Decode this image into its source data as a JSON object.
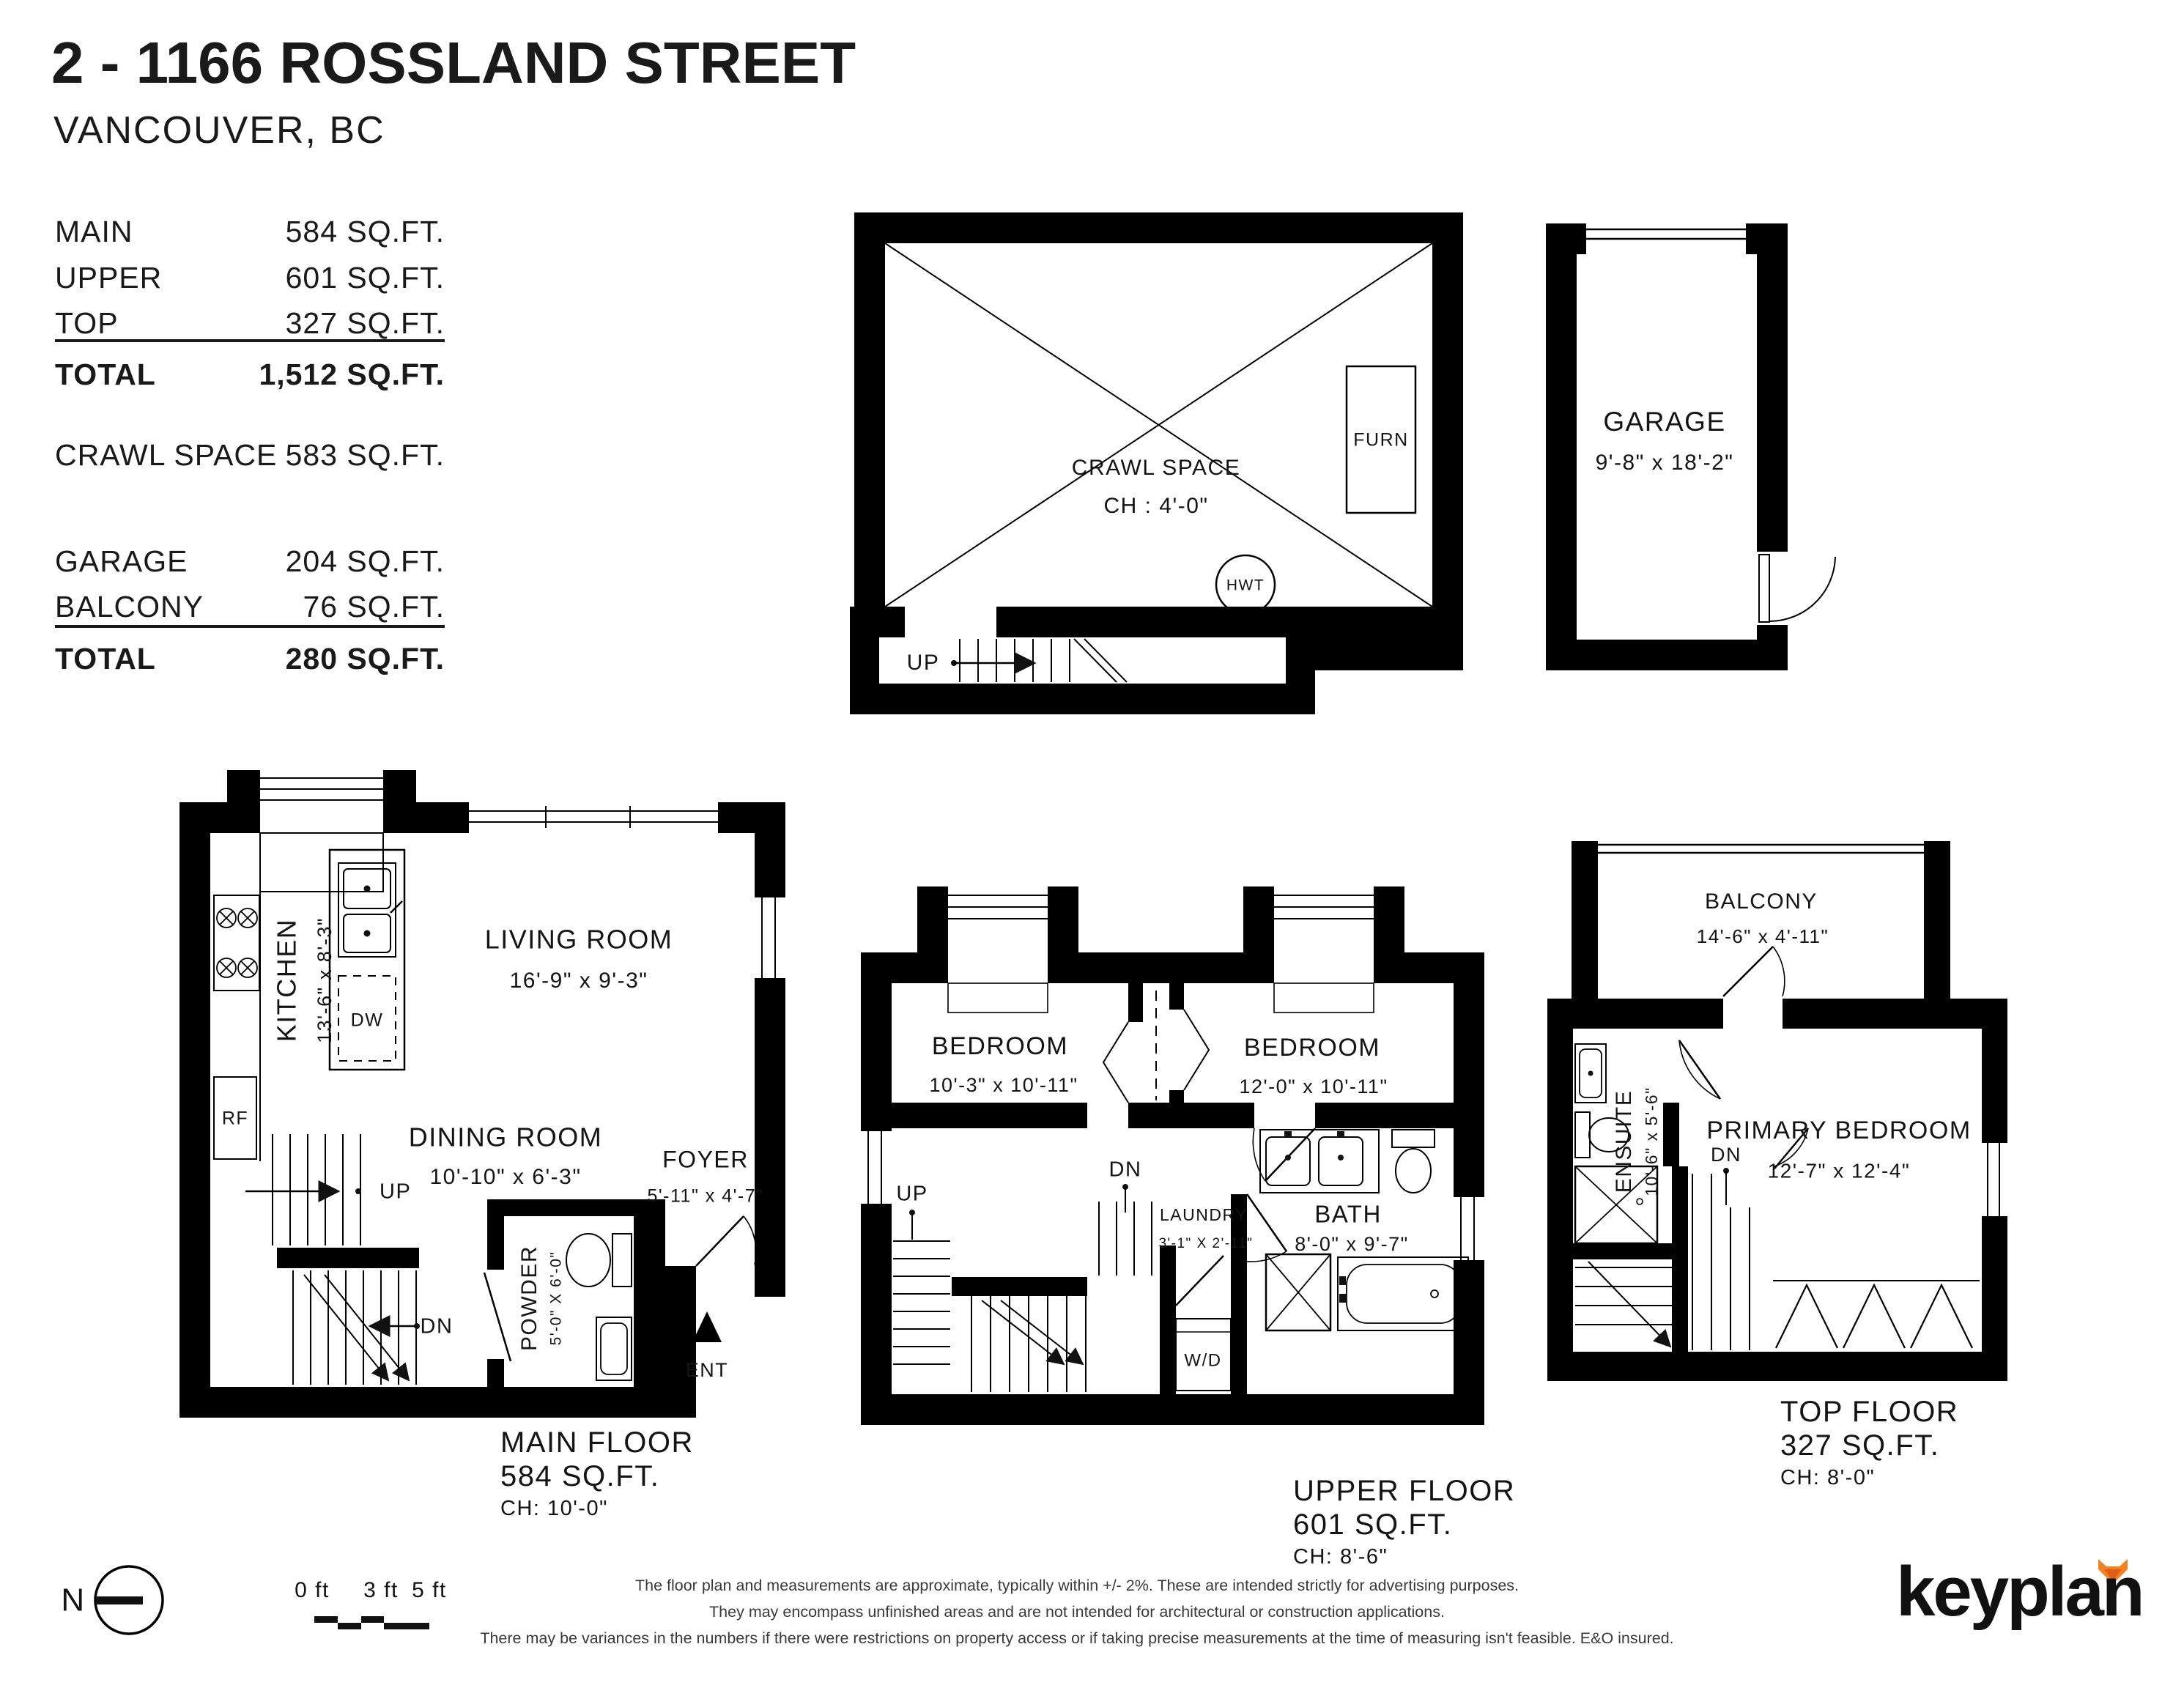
{
  "header": {
    "title": "2 - 1166 ROSSLAND STREET",
    "subtitle": "VANCOUVER, BC"
  },
  "areas": {
    "main": {
      "label": "MAIN",
      "value": "584 SQ.FT."
    },
    "upper": {
      "label": "UPPER",
      "value": "601 SQ.FT."
    },
    "top": {
      "label": "TOP",
      "value": "327 SQ.FT."
    },
    "total1": {
      "label": "TOTAL",
      "value": "1,512 SQ.FT."
    },
    "crawl": {
      "label": "CRAWL SPACE",
      "value": "583 SQ.FT."
    },
    "garage": {
      "label": "GARAGE",
      "value": "204 SQ.FT."
    },
    "balcony": {
      "label": "BALCONY",
      "value": "76 SQ.FT."
    },
    "total2": {
      "label": "TOTAL",
      "value": "280 SQ.FT."
    }
  },
  "crawl_plan": {
    "room": "CRAWL SPACE",
    "ch": "CH : 4'-0\"",
    "furnace": "FURN",
    "water_tank": "HWT",
    "up": "UP"
  },
  "garage_plan": {
    "room": "GARAGE",
    "dims": "9'-8\"  x  18'-2\""
  },
  "main_plan": {
    "kitchen": {
      "name": "KITCHEN",
      "dims": "13'-6\"  x  8'-3\""
    },
    "living": {
      "name": "LIVING ROOM",
      "dims": "16'-9\"  x  9'-3\""
    },
    "dining": {
      "name": "DINING ROOM",
      "dims": "10'-10\" x  6'-3\""
    },
    "foyer": {
      "name": "FOYER",
      "dims": "5'-11\" x  4'-7\""
    },
    "powder": {
      "name": "POWDER",
      "dims": "5'-0\" X 6'-0\""
    },
    "rf": "RF",
    "dw": "DW",
    "up": "UP",
    "dn": "DN",
    "ent": "ENT",
    "floor": {
      "name": "MAIN FLOOR",
      "area": "584 SQ.FT.",
      "ch": "CH: 10'-0\""
    }
  },
  "upper_plan": {
    "bedroom1": {
      "name": "BEDROOM",
      "dims": "10'-3\"  x  10'-11\""
    },
    "bedroom2": {
      "name": "BEDROOM",
      "dims": "12'-0\"  x  10'-11\""
    },
    "laundry": {
      "name": "LAUNDRY",
      "dims": "3'-1\" X 2'-11\""
    },
    "bath": {
      "name": "BATH",
      "dims": "8'-0\"  x  9'-7\""
    },
    "wd": "W/D",
    "up": "UP",
    "dn": "DN",
    "floor": {
      "name": "UPPER FLOOR",
      "area": "601 SQ.FT.",
      "ch": "CH: 8'-6\""
    }
  },
  "top_plan": {
    "balcony": {
      "name": "BALCONY",
      "dims": "14'-6\"  x  4'-11\""
    },
    "ensuite": {
      "name": "ENSUITE",
      "dims": "10'-6\"  x  5'-6\""
    },
    "primary": {
      "name": "PRIMARY BEDROOM",
      "dims": "12'-7\"  x  12'-4\""
    },
    "dn": "DN",
    "floor": {
      "name": "TOP FLOOR",
      "area": "327 SQ.FT.",
      "ch": "CH: 8'-0\""
    }
  },
  "footer": {
    "north": "N",
    "scale": {
      "labels": [
        "0 ft",
        "3 ft",
        "5 ft"
      ]
    },
    "disclaimer": [
      "The floor plan and measurements are approximate, typically within +/- 2%. These are intended strictly for advertising purposes.",
      "They may encompass unfinished areas and are not intended for architectural or construction applications.",
      "There may be variances in the numbers if there were restrictions on property access or if taking precise measurements at the time of measuring isn't feasible. E&O insured."
    ],
    "brand": "keyplan",
    "brand_color": "#F5821F"
  }
}
